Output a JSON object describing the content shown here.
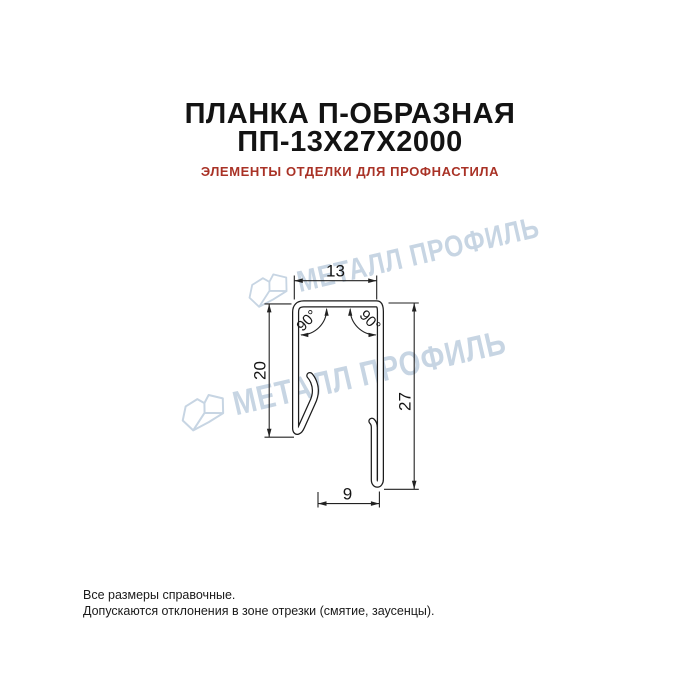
{
  "header": {
    "title_line1": "ПЛАНКА П-ОБРАЗНАЯ",
    "title_line2": "ПП-13Х27Х2000",
    "subtitle": "ЭЛЕМЕНТЫ ОТДЕЛКИ ДЛЯ ПРОФНАСТИЛА"
  },
  "drawing": {
    "type": "technical-cross-section",
    "dimensions": {
      "top_width": "13",
      "left_height": "20",
      "right_height": "27",
      "bottom_width": "9",
      "left_angle": "90°",
      "right_angle": "90°"
    }
  },
  "watermark": {
    "text": "МЕТАЛЛ ПРОФИЛЬ",
    "color": "#c7d5e3"
  },
  "footer": {
    "line1": "Все размеры справочные.",
    "line2": "Допускаются отклонения в зоне отрезки (смятие, заусенцы)."
  },
  "colors": {
    "background": "#ffffff",
    "title": "#131313",
    "subtitle": "#a93226",
    "drawing_line": "#1c1c1c"
  }
}
